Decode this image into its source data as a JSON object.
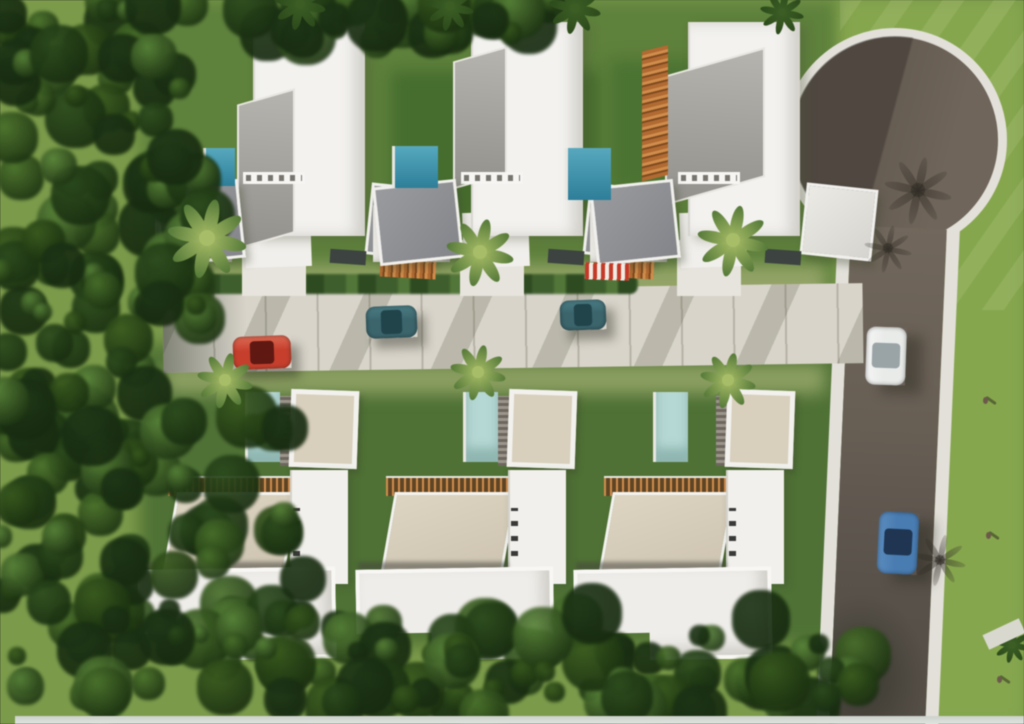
{
  "scene": {
    "description": "Aerial 3D architectural rendering of a gated residential development: two rows of three modern white villas with private pools along a central paved lane, a vertical access road on the right ending in a circular cul-de-sac, dense forest on the left, hedge row at the bottom, five cars and three pedestrians.",
    "canvas": {
      "w": 1024,
      "h": 724
    },
    "palette": {
      "grass_base": "#7b9a4b",
      "grass_mid": "#5e813d",
      "grass_dark": "#4f7136",
      "grass_bright": "#86a64f",
      "forest_colors": [
        "#1d3416",
        "#2b4a1e",
        "#38591f",
        "#49702c",
        "#59833a"
      ],
      "hedge_colors": [
        "#2e4a22",
        "#3f5e2e",
        "#52763a",
        "#6d9242"
      ],
      "street": "#d8d4ca",
      "street_joint": "rgba(120,115,100,0.35)",
      "asphalt_light": "#71675c",
      "asphalt_dark": "#59524b",
      "curb": "#e2e0d9",
      "wall_white": "#f3f2ef",
      "roof_white": "#efede9",
      "roof_gray_a": "#b6b4af",
      "roof_gray_b": "#93918c",
      "panel_gray_a": "#9a9b9e",
      "panel_gray_b": "#84858a",
      "roof_beige_a": "#ddd4c2",
      "roof_beige_b": "#cdc3b0",
      "wood": "#b06a33",
      "wood_dark": "#7c4a20",
      "wood_light": "#cf8d4d",
      "pool_top_a": "#58a8bd",
      "pool_top_b": "#2f7e98",
      "pool_pale": "#b7d8d4",
      "awning_red": "#c23b2a",
      "shadow_veil": "rgba(40,36,32,0.45)"
    },
    "grass_patches": [
      {
        "x": 140,
        "y": 0,
        "w": 700,
        "h": 300,
        "color": "#5e813d"
      },
      {
        "x": 840,
        "y": 0,
        "w": 184,
        "h": 724,
        "color": "#86a64f"
      },
      {
        "x": 140,
        "y": 345,
        "w": 720,
        "h": 300,
        "color": "#4f7136"
      },
      {
        "x": 390,
        "y": 70,
        "w": 210,
        "h": 150,
        "color": "#476d2f"
      },
      {
        "x": 610,
        "y": 60,
        "w": 160,
        "h": 130,
        "color": "#4c7233"
      },
      {
        "x": 165,
        "y": 265,
        "w": 660,
        "h": 40,
        "color": "#93a368"
      },
      {
        "x": 165,
        "y": 364,
        "w": 660,
        "h": 30,
        "color": "#8c9f63"
      }
    ],
    "forest_regions": [
      {
        "x": 0,
        "y": 0,
        "w": 170,
        "h": 480,
        "count": 95,
        "seed": 11
      },
      {
        "x": 0,
        "y": 390,
        "w": 310,
        "h": 334,
        "count": 90,
        "seed": 22
      },
      {
        "x": 150,
        "y": 0,
        "w": 60,
        "h": 320,
        "count": 28,
        "seed": 33
      },
      {
        "x": 240,
        "y": 0,
        "w": 330,
        "h": 42,
        "count": 34,
        "seed": 44
      },
      {
        "x": 230,
        "y": 612,
        "w": 650,
        "h": 104,
        "count": 85,
        "seed": 55
      }
    ],
    "culdesac": {
      "cx": 895,
      "cy": 140,
      "r": 112,
      "curb_w": 9
    },
    "right_road": {
      "x": 838,
      "y": 225,
      "w": 122,
      "h": 505,
      "angle": 2.5,
      "sidewalk_w": 13
    },
    "street": {
      "x": 163,
      "y": 288,
      "w": 700,
      "h": 80,
      "angle": -0.8
    },
    "driveways_y": 240,
    "houses_top": [
      {
        "id": "villa-top-left",
        "ox": 150,
        "roof": {
          "x": 87,
          "y": 88,
          "w": 58,
          "h": 145
        },
        "pergola_strip": true,
        "awning": false,
        "right_panel_white": false
      },
      {
        "id": "villa-top-middle",
        "ox": 368,
        "roof": {
          "x": 85,
          "y": 46,
          "w": 54,
          "h": 128
        },
        "pergola_strip": true,
        "awning": false,
        "right_panel_white": false
      },
      {
        "id": "villa-top-right",
        "ox": 585,
        "roof": {
          "x": 80,
          "y": 47,
          "w": 100,
          "h": 130
        },
        "pergola_strip": false,
        "awning": true,
        "right_panel_white": true,
        "wood_wall": {
          "x": 57,
          "y": 45,
          "w": 26,
          "h": 130
        }
      }
    ],
    "pools_top": [
      {
        "x": 203,
        "y": 148,
        "w": 32,
        "h": 38
      },
      {
        "x": 392,
        "y": 146,
        "w": 46,
        "h": 42
      },
      {
        "x": 565,
        "y": 148,
        "w": 46,
        "h": 52
      }
    ],
    "houses_bottom": [
      {
        "id": "villa-bottom-left",
        "ox": 140,
        "oy": 388
      },
      {
        "id": "villa-bottom-middle",
        "ox": 358,
        "oy": 388
      },
      {
        "id": "villa-bottom-right",
        "ox": 576,
        "oy": 388,
        "pool_dx": -28
      }
    ],
    "cars": [
      {
        "id": "car-red",
        "x": 233,
        "y": 336,
        "w": 58,
        "h": 33,
        "angle": -2,
        "body": "#c4402e",
        "hood": "#da6a55",
        "glass": "#5e1812",
        "dir": "h"
      },
      {
        "id": "car-teal-1",
        "x": 366,
        "y": 306,
        "w": 51,
        "h": 32,
        "angle": -2,
        "body": "#3c646b",
        "hood": "#4d7d85",
        "glass": "#22444b",
        "dir": "h"
      },
      {
        "id": "car-teal-2",
        "x": 560,
        "y": 300,
        "w": 46,
        "h": 30,
        "angle": -2,
        "body": "#3c646b",
        "hood": "#4d7d85",
        "glass": "#22444b",
        "dir": "h"
      },
      {
        "id": "car-white",
        "x": 866,
        "y": 327,
        "w": 40,
        "h": 58,
        "angle": 2,
        "body": "#e9ebe9",
        "hood": "#f4f5f4",
        "glass": "#9aa3a6",
        "dir": "v"
      },
      {
        "id": "car-blue",
        "x": 878,
        "y": 512,
        "w": 40,
        "h": 62,
        "angle": 3,
        "body": "#4a7cb0",
        "hood": "#5c8cbd",
        "glass": "#1f3550",
        "dir": "v"
      }
    ],
    "palms_light": [
      {
        "x": 207,
        "y": 238,
        "r": 40
      },
      {
        "x": 480,
        "y": 252,
        "r": 34
      },
      {
        "x": 733,
        "y": 240,
        "r": 36
      },
      {
        "x": 225,
        "y": 380,
        "r": 28
      },
      {
        "x": 478,
        "y": 372,
        "r": 28
      },
      {
        "x": 728,
        "y": 380,
        "r": 28
      }
    ],
    "palms_dark": [
      {
        "x": 575,
        "y": 8,
        "r": 26
      },
      {
        "x": 782,
        "y": 12,
        "r": 22
      },
      {
        "x": 300,
        "y": 4,
        "r": 26
      },
      {
        "x": 450,
        "y": 6,
        "r": 24
      },
      {
        "x": 1012,
        "y": 645,
        "r": 18
      }
    ],
    "palm_shadows": [
      {
        "x": 918,
        "y": 190,
        "r": 34
      },
      {
        "x": 888,
        "y": 248,
        "r": 24
      },
      {
        "x": 940,
        "y": 560,
        "r": 26
      }
    ],
    "people": [
      {
        "x": 983,
        "y": 397
      },
      {
        "x": 986,
        "y": 532
      },
      {
        "x": 997,
        "y": 676
      }
    ],
    "bottom_strip": {
      "x": 15,
      "y": 716,
      "w": 1009,
      "h": 8,
      "color": "#ccd1ca"
    },
    "corner_path": {
      "x": 984,
      "y": 626,
      "w": 40,
      "h": 16,
      "color": "#d8d8cf",
      "angle": -25
    }
  }
}
